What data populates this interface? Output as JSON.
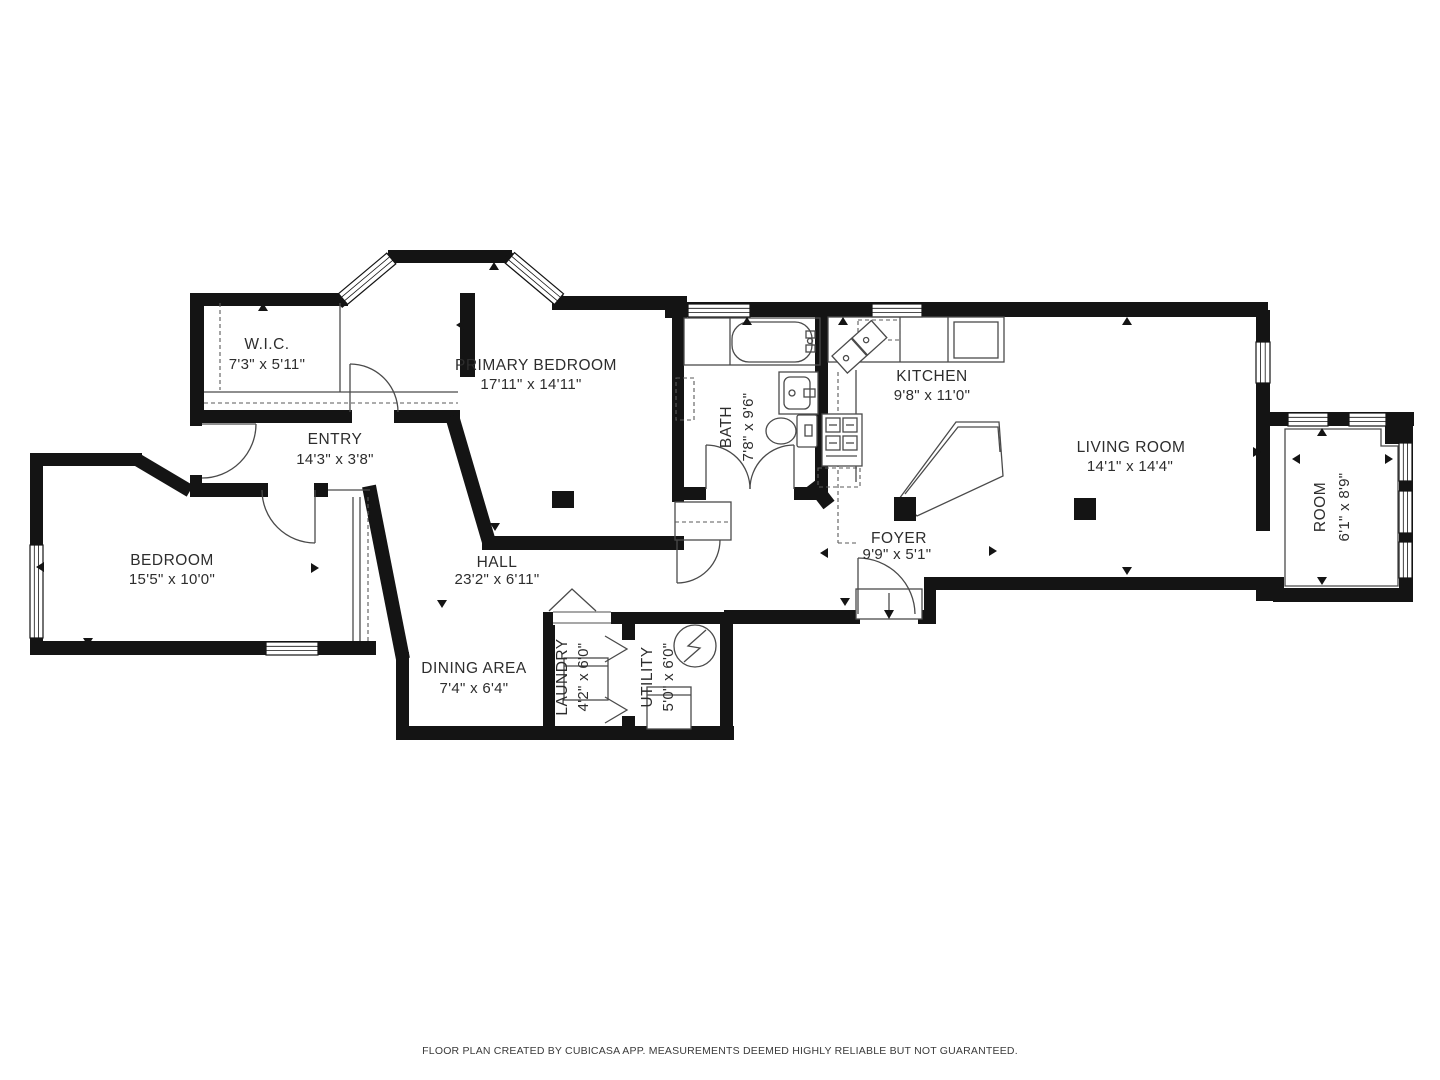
{
  "floorplan": {
    "footer": "FLOOR PLAN CREATED BY CUBICASA APP. MEASUREMENTS DEEMED HIGHLY RELIABLE BUT NOT GUARANTEED.",
    "colors": {
      "walls": "#141414",
      "background": "#ffffff",
      "text": "#2d2d2d"
    },
    "rooms": [
      {
        "name": "W.I.C.",
        "dims": "7'3\" x 5'11\""
      },
      {
        "name": "PRIMARY BEDROOM",
        "dims": "17'11\" x 14'11\""
      },
      {
        "name": "ENTRY",
        "dims": "14'3\" x 3'8\""
      },
      {
        "name": "BEDROOM",
        "dims": "15'5\" x 10'0\""
      },
      {
        "name": "HALL",
        "dims": "23'2\" x 6'11\""
      },
      {
        "name": "DINING AREA",
        "dims": "7'4\" x 6'4\""
      },
      {
        "name": "LAUNDRY",
        "dims": "4'2\" x 6'0\""
      },
      {
        "name": "UTILITY",
        "dims": "5'0\" x 6'0\""
      },
      {
        "name": "BATH",
        "dims": "7'8\" x 9'6\""
      },
      {
        "name": "KITCHEN",
        "dims": "9'8\" x 11'0\""
      },
      {
        "name": "FOYER",
        "dims": "9'9\" x 5'1\""
      },
      {
        "name": "LIVING ROOM",
        "dims": "14'1\" x 14'4\""
      },
      {
        "name": "ROOM",
        "dims": "6'1\" x 8'9\""
      }
    ]
  }
}
